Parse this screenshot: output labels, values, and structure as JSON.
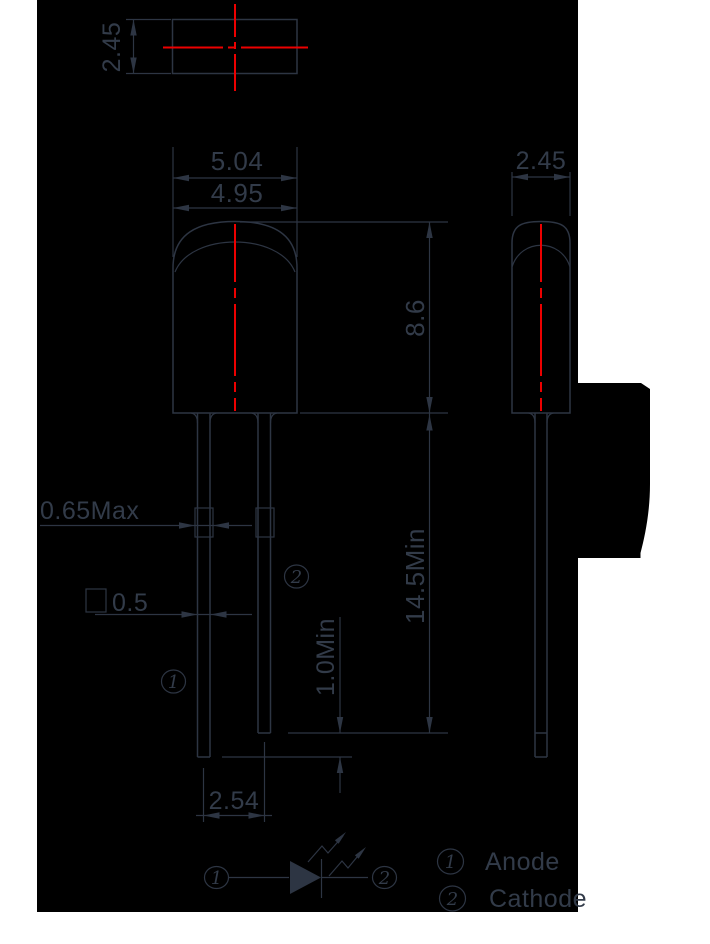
{
  "title": "LED package dimension drawing",
  "dims": {
    "top_height": "2.45",
    "front_width_outer": "5.04",
    "front_width_inner": "4.95",
    "front_body_height": "8.6",
    "front_lead_length": "14.5Min",
    "lead_kink_width": "0.65Max",
    "lead_square_width": "0.5",
    "lead_tip_offset": "1.0Min",
    "lead_pitch": "2.54",
    "side_depth": "2.45"
  },
  "pins": {
    "anode_num": "1",
    "cathode_num": "2"
  },
  "legend": {
    "anode_num": "1",
    "anode_label": "Anode",
    "cathode_num": "2",
    "cathode_label": "Cathode"
  },
  "colors": {
    "page_bg": "#ffffff",
    "drawing_bg": "#000000",
    "line": "#2d3543",
    "text": "#323b49",
    "centerline_red": "#ec0000"
  }
}
